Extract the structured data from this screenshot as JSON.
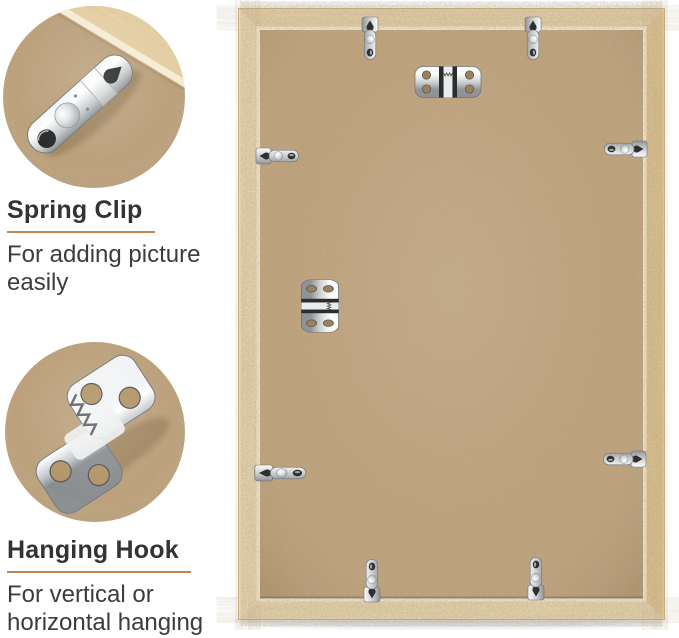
{
  "callouts": [
    {
      "title": "Spring Clip",
      "description": "For adding picture easily",
      "photo": "spring-clip-closeup"
    },
    {
      "title": "Hanging Hook",
      "description": "For vertical or horizontal hanging",
      "photo": "hanging-hook-closeup"
    }
  ],
  "colors": {
    "background": "#ffffff",
    "text": "#333333",
    "underline": "#c5854f",
    "board": "#c2a57d",
    "wood_lip": "#f5ead0",
    "groove": "#6f5f43",
    "metal_light": "#fbfcfc",
    "metal_mid": "#c9ccce",
    "metal_dark": "#8f9396",
    "hole": "#2f2f2f"
  },
  "frame_back": {
    "hardware": [
      {
        "type": "spring-clip",
        "x": 370,
        "y": 38,
        "rot": 90
      },
      {
        "type": "spring-clip",
        "x": 533,
        "y": 38,
        "rot": 90
      },
      {
        "type": "spring-clip",
        "x": 277,
        "y": 156,
        "rot": 0
      },
      {
        "type": "spring-clip",
        "x": 626,
        "y": 149,
        "rot": 180
      },
      {
        "type": "spring-clip",
        "x": 280,
        "y": 473,
        "rot": 0,
        "sx": 1.2,
        "sy": 1
      },
      {
        "type": "spring-clip",
        "x": 625,
        "y": 459,
        "rot": 180
      },
      {
        "type": "spring-clip",
        "x": 372,
        "y": 581,
        "rot": -90
      },
      {
        "type": "spring-clip",
        "x": 536,
        "y": 579,
        "rot": -90
      },
      {
        "type": "hanging-hook",
        "x": 448,
        "y": 82,
        "rot": 0
      },
      {
        "type": "hanging-hook",
        "x": 320,
        "y": 306,
        "rot": 90,
        "sx": 0.8,
        "sy": 1.2
      }
    ]
  }
}
